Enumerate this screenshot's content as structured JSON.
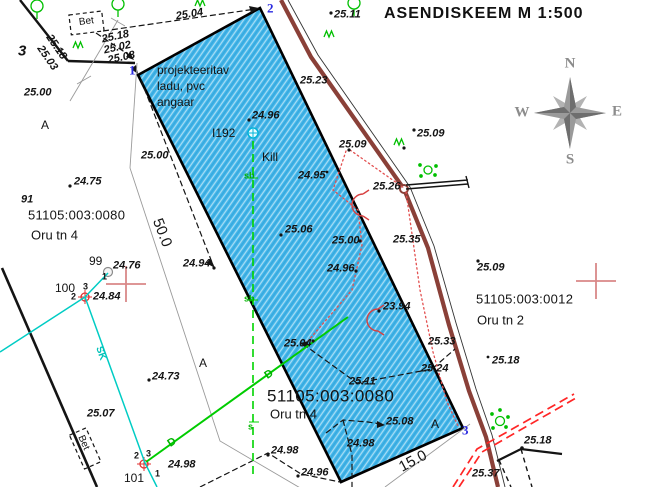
{
  "title": "ASENDISKEEM   M 1:500",
  "compass": {
    "n": "N",
    "e": "E",
    "s": "S",
    "w": "W"
  },
  "building_note": {
    "lines": [
      "projekteeritav",
      "ladu, pvc",
      "angaar"
    ]
  },
  "parcels": [
    {
      "code": "51105:003:0080",
      "street": "Oru tn 4"
    },
    {
      "code": "51105:003:0012",
      "street": "Oru tn 2"
    }
  ],
  "colors": {
    "planned_area_blue": "#3fb4e8",
    "road_brown": "#8a4038",
    "utility_green": "#00c400",
    "utility_cyan": "#00ccc4",
    "marker_red": "#e03030",
    "grid_cross_pink": "#d98888",
    "vertex_blue": "#2a2ae0",
    "compass_gray": "#9a9a9a"
  },
  "labels": [
    {
      "t": "25.04",
      "x": 176,
      "y": 17,
      "r": -9,
      "c": "elev"
    },
    {
      "t": "25.11",
      "x": 334,
      "y": 15,
      "c": "elev"
    },
    {
      "t": "25.18",
      "x": 102,
      "y": 40,
      "r": -12,
      "c": "elev"
    },
    {
      "t": "25.02",
      "x": 104,
      "y": 51,
      "r": -12,
      "c": "elev"
    },
    {
      "t": "25.08",
      "x": 108,
      "y": 61,
      "r": -12,
      "c": "elev"
    },
    {
      "t": "25.18",
      "x": 48,
      "y": 36,
      "r": 55,
      "c": "elev"
    },
    {
      "t": "25.03",
      "x": 39,
      "y": 47,
      "r": 55,
      "c": "elev"
    },
    {
      "t": "3",
      "x": 18,
      "y": 51,
      "c": "big"
    },
    {
      "t": "25.00",
      "x": 24,
      "y": 93,
      "c": "elev"
    },
    {
      "t": "A",
      "x": 41,
      "y": 125,
      "c": "pt"
    },
    {
      "t": "25.00",
      "x": 141,
      "y": 156,
      "c": "elev"
    },
    {
      "t": "projekteeritav",
      "x": 157,
      "y": 70,
      "c": "txt"
    },
    {
      "t": "ladu, pvc",
      "x": 157,
      "y": 86,
      "c": "txt"
    },
    {
      "t": "angaar",
      "x": 157,
      "y": 102,
      "c": "txt"
    },
    {
      "t": "24.96",
      "x": 252,
      "y": 116,
      "c": "elev"
    },
    {
      "t": "I192",
      "x": 212,
      "y": 133,
      "c": "txt"
    },
    {
      "t": "Kill",
      "x": 262,
      "y": 157,
      "c": "txt"
    },
    {
      "t": "25.23",
      "x": 300,
      "y": 81,
      "c": "elev"
    },
    {
      "t": "25.09",
      "x": 339,
      "y": 145,
      "c": "elev"
    },
    {
      "t": "25.09",
      "x": 417,
      "y": 134,
      "c": "elev"
    },
    {
      "t": "25.26",
      "x": 373,
      "y": 187,
      "c": "elev"
    },
    {
      "t": "24.95",
      "x": 298,
      "y": 176,
      "c": "elev"
    },
    {
      "t": "25.06",
      "x": 285,
      "y": 230,
      "c": "elev"
    },
    {
      "t": "25.00",
      "x": 332,
      "y": 241,
      "c": "elev"
    },
    {
      "t": "25.35",
      "x": 393,
      "y": 240,
      "c": "elev"
    },
    {
      "t": "24.96",
      "x": 327,
      "y": 269,
      "c": "elev"
    },
    {
      "t": "23.94",
      "x": 383,
      "y": 307,
      "c": "elev"
    },
    {
      "t": "24.75",
      "x": 74,
      "y": 182,
      "c": "elev"
    },
    {
      "t": "91",
      "x": 21,
      "y": 200,
      "c": "elev"
    },
    {
      "t": "51105:003:0080",
      "x": 28,
      "y": 215,
      "c": "parcel"
    },
    {
      "t": "Oru tn 4",
      "x": 31,
      "y": 235,
      "c": "street"
    },
    {
      "t": "50.0",
      "x": 157,
      "y": 219,
      "r": 69,
      "c": "dim"
    },
    {
      "t": "24.94",
      "x": 183,
      "y": 264,
      "c": "elev"
    },
    {
      "t": "99",
      "x": 89,
      "y": 261,
      "c": "pt"
    },
    {
      "t": "24.76",
      "x": 113,
      "y": 266,
      "c": "elev"
    },
    {
      "t": "1",
      "x": 102,
      "y": 277,
      "c": "pt-s"
    },
    {
      "t": "100",
      "x": 55,
      "y": 288,
      "c": "pt"
    },
    {
      "t": "3",
      "x": 83,
      "y": 287,
      "c": "pt-s"
    },
    {
      "t": "2",
      "x": 71,
      "y": 297,
      "c": "pt-s"
    },
    {
      "t": "24.84",
      "x": 93,
      "y": 297,
      "c": "elev"
    },
    {
      "t": "25.09",
      "x": 477,
      "y": 268,
      "c": "elev"
    },
    {
      "t": "51105:003:0012",
      "x": 476,
      "y": 299,
      "c": "parcel"
    },
    {
      "t": "Oru tn 2",
      "x": 477,
      "y": 320,
      "c": "street"
    },
    {
      "t": "25.18",
      "x": 492,
      "y": 361,
      "c": "elev"
    },
    {
      "t": "25.33",
      "x": 428,
      "y": 342,
      "c": "elev"
    },
    {
      "t": "25.24",
      "x": 421,
      "y": 369,
      "c": "elev"
    },
    {
      "t": "25.11",
      "x": 349,
      "y": 382,
      "c": "elev"
    },
    {
      "t": "25.04",
      "x": 284,
      "y": 344,
      "c": "elev"
    },
    {
      "t": "51105:003:0080",
      "x": 267,
      "y": 396,
      "c": "parcel-lg"
    },
    {
      "t": "Oru tn 4",
      "x": 270,
      "y": 414,
      "c": "street"
    },
    {
      "t": "25.08",
      "x": 386,
      "y": 422,
      "c": "elev"
    },
    {
      "t": "24.98",
      "x": 347,
      "y": 444,
      "c": "elev"
    },
    {
      "t": "A",
      "x": 431,
      "y": 424,
      "c": "pt"
    },
    {
      "t": "3",
      "x": 462,
      "y": 430,
      "c": "vtx"
    },
    {
      "t": "15.0",
      "x": 400,
      "y": 468,
      "r": -28,
      "c": "dim15"
    },
    {
      "t": "24.73",
      "x": 152,
      "y": 377,
      "c": "elev"
    },
    {
      "t": "A",
      "x": 199,
      "y": 363,
      "c": "pt"
    },
    {
      "t": "SK",
      "x": 98,
      "y": 347,
      "r": 71,
      "c": "cy"
    },
    {
      "t": "25.07",
      "x": 87,
      "y": 414,
      "c": "elev"
    },
    {
      "t": "Bet",
      "x": 80,
      "y": 436,
      "r": 66,
      "c": "bet"
    },
    {
      "t": "D",
      "x": 169,
      "y": 445,
      "r": -34,
      "c": "grn"
    },
    {
      "t": "D",
      "x": 266,
      "y": 377,
      "r": -34,
      "c": "grn"
    },
    {
      "t": "s",
      "x": 248,
      "y": 427,
      "c": "grn-s"
    },
    {
      "t": "sb",
      "x": 244,
      "y": 176,
      "c": "grn-s"
    },
    {
      "t": "sb",
      "x": 244,
      "y": 299,
      "c": "grn-s"
    },
    {
      "t": "2",
      "x": 134,
      "y": 456,
      "c": "pt-s"
    },
    {
      "t": "3",
      "x": 146,
      "y": 454,
      "c": "pt-s"
    },
    {
      "t": "24.98",
      "x": 168,
      "y": 465,
      "c": "elev"
    },
    {
      "t": "1",
      "x": 155,
      "y": 474,
      "c": "pt-s"
    },
    {
      "t": "101",
      "x": 124,
      "y": 478,
      "c": "pt"
    },
    {
      "t": "24.98",
      "x": 271,
      "y": 451,
      "c": "elev"
    },
    {
      "t": "24.96",
      "x": 301,
      "y": 473,
      "c": "elev"
    },
    {
      "t": "25.18",
      "x": 524,
      "y": 441,
      "c": "elev"
    },
    {
      "t": "25.37",
      "x": 472,
      "y": 474,
      "c": "elev"
    },
    {
      "t": "1",
      "x": 129,
      "y": 70,
      "c": "vtx"
    },
    {
      "t": "2",
      "x": 267,
      "y": 8,
      "c": "vtx"
    },
    {
      "t": "Bet",
      "x": 79,
      "y": 23,
      "r": -7,
      "c": "bet"
    }
  ]
}
